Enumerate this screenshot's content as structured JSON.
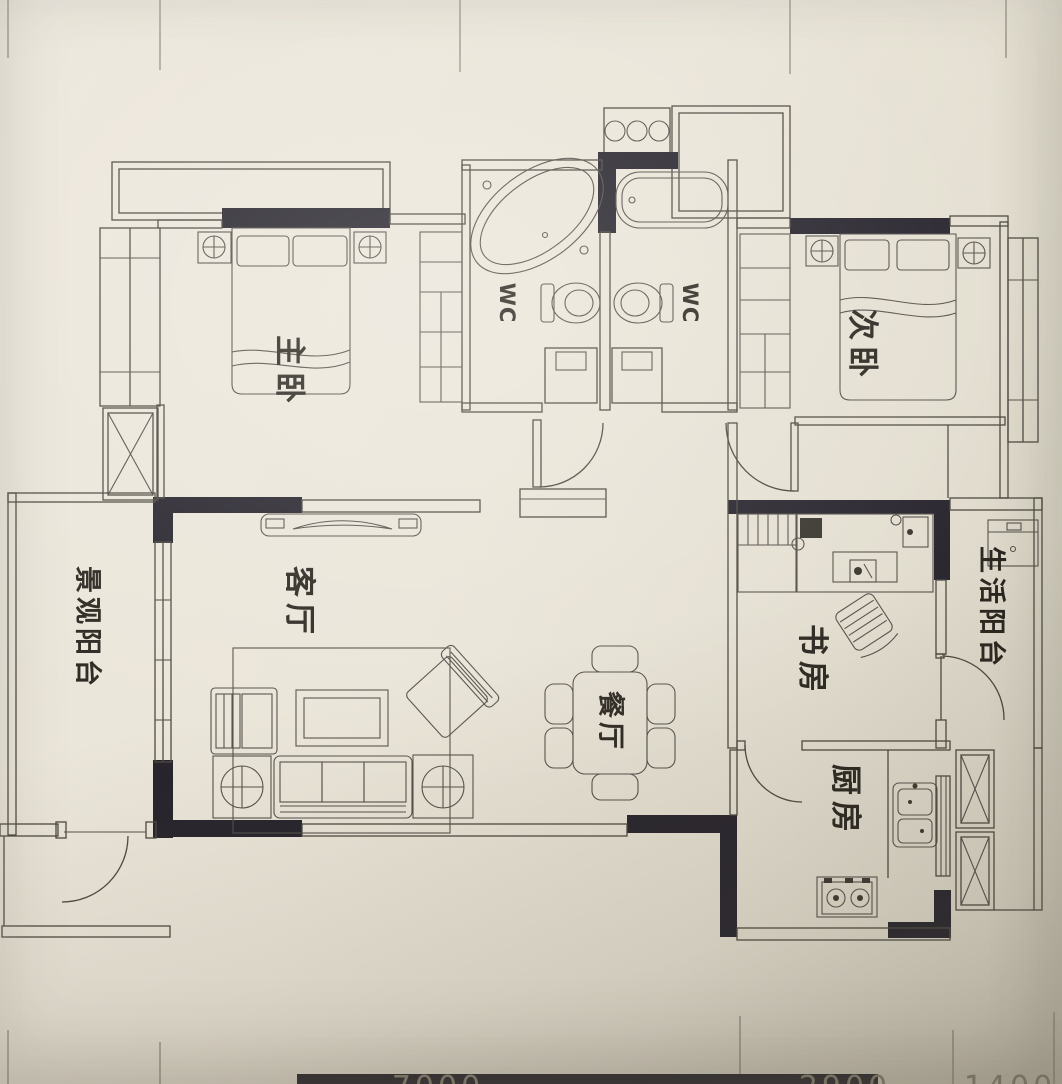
{
  "plan": {
    "rooms": {
      "master_bedroom": "主卧",
      "second_bedroom": "次卧",
      "living_room": "客厅",
      "dining_room": "餐厅",
      "study": "书房",
      "kitchen": "厨房",
      "view_balcony": "景观阳台",
      "utility_balcony": "生活阳台",
      "wc_left": "WC",
      "wc_right": "WC"
    },
    "dimensions": {
      "bottom": [
        "7000",
        "2900",
        "1400"
      ]
    },
    "colors": {
      "paper": "#e9e4d8",
      "line": "#4c483f",
      "wall_fill": "#26232c",
      "label_text": "#2b2720",
      "dimension_text": "#8a8476"
    }
  }
}
